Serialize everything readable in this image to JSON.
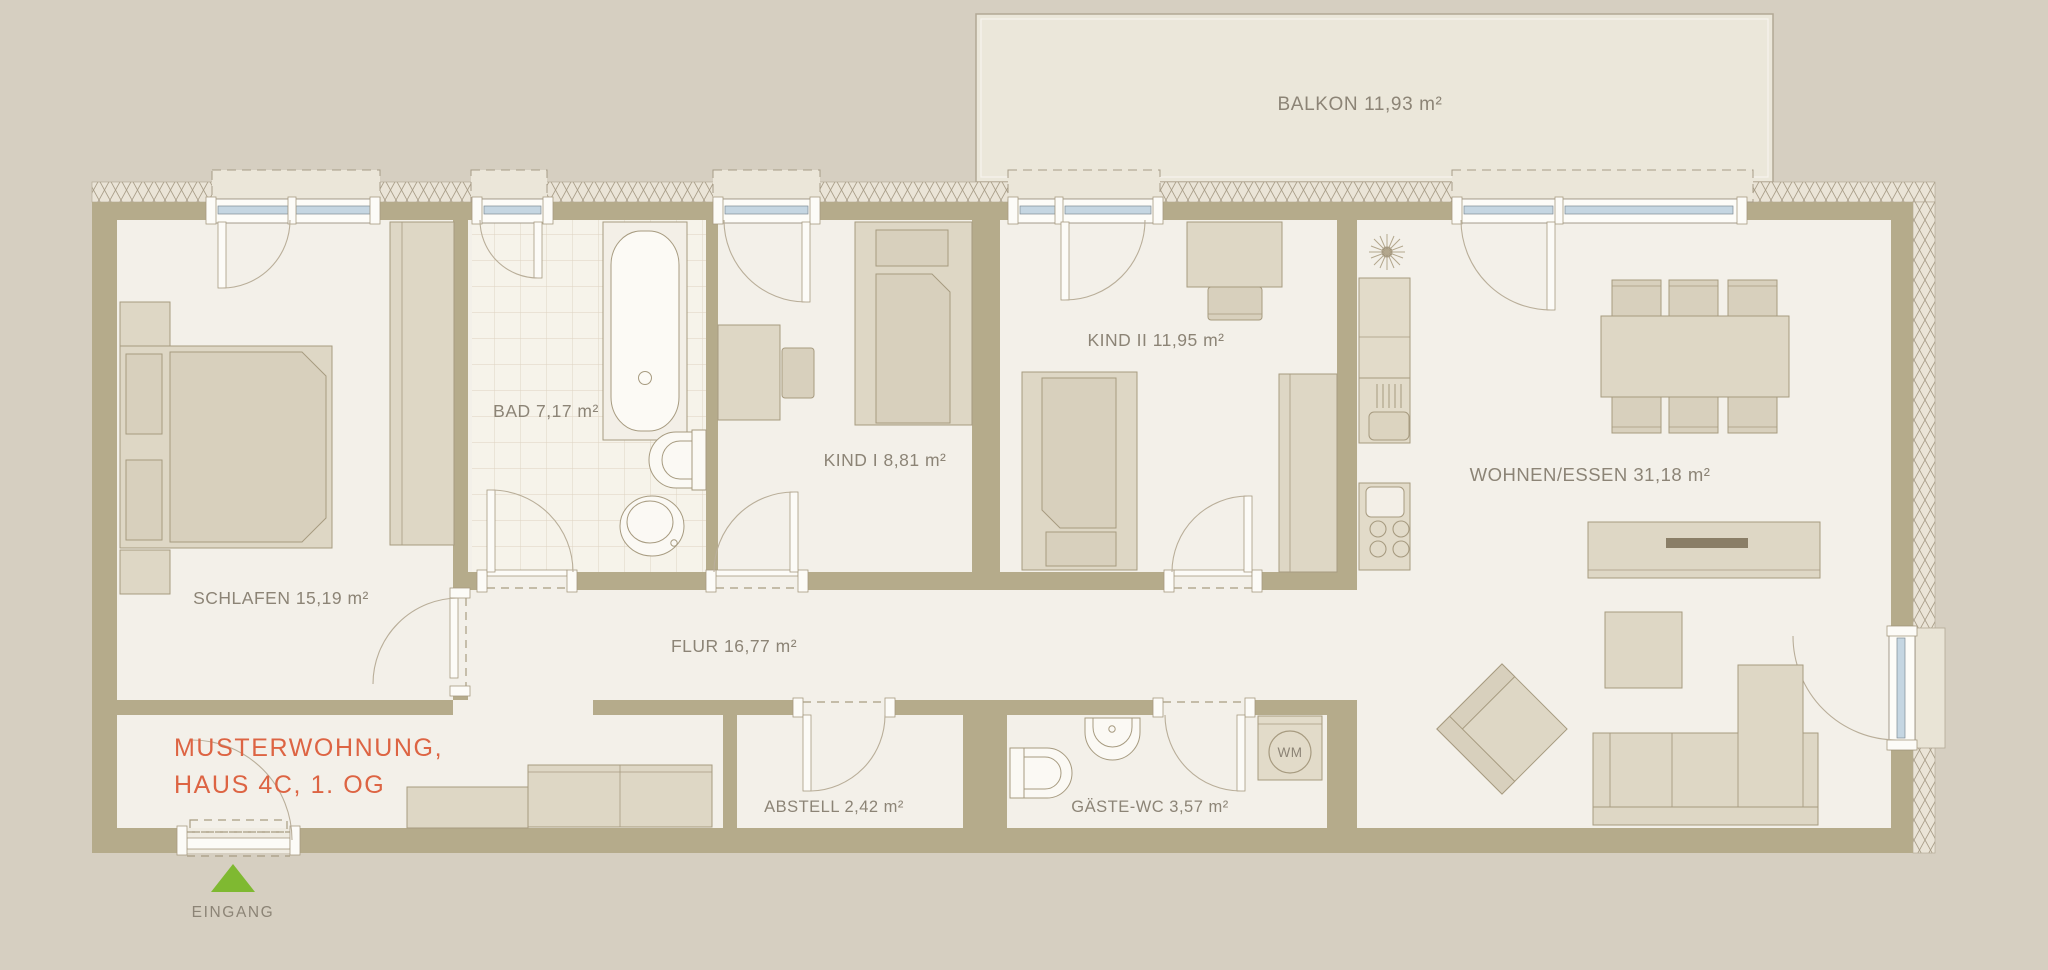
{
  "plan": {
    "title_line1": "MUSTERWOHNUNG,",
    "title_line2": "HAUS 4C, 1. OG",
    "entrance_label": "EINGANG",
    "balcony_label": "BALKON 11,93 m²",
    "rooms": {
      "schlafen": "SCHLAFEN 15,19 m²",
      "bad": "BAD 7,17 m²",
      "kind1": "KIND I 8,81 m²",
      "kind2": "KIND II 11,95 m²",
      "wohnen_essen": "WOHNEN/ESSEN 31,18 m²",
      "flur": "FLUR 16,77 m²",
      "abstell": "ABSTELL 2,42 m²",
      "gaeste_wc": "GÄSTE-WC 3,57 m²"
    },
    "appliances": {
      "washing_machine": "WM"
    },
    "colors": {
      "background": "#d6cfc1",
      "floor": "#f3f0e9",
      "wall": "#b5ab8b",
      "balcony": "#ebe7da",
      "accent_title": "#dd6443",
      "entrance_arrow": "#7fb931",
      "window_glass": "#c5d6e2",
      "label_text": "#8c8476"
    }
  }
}
